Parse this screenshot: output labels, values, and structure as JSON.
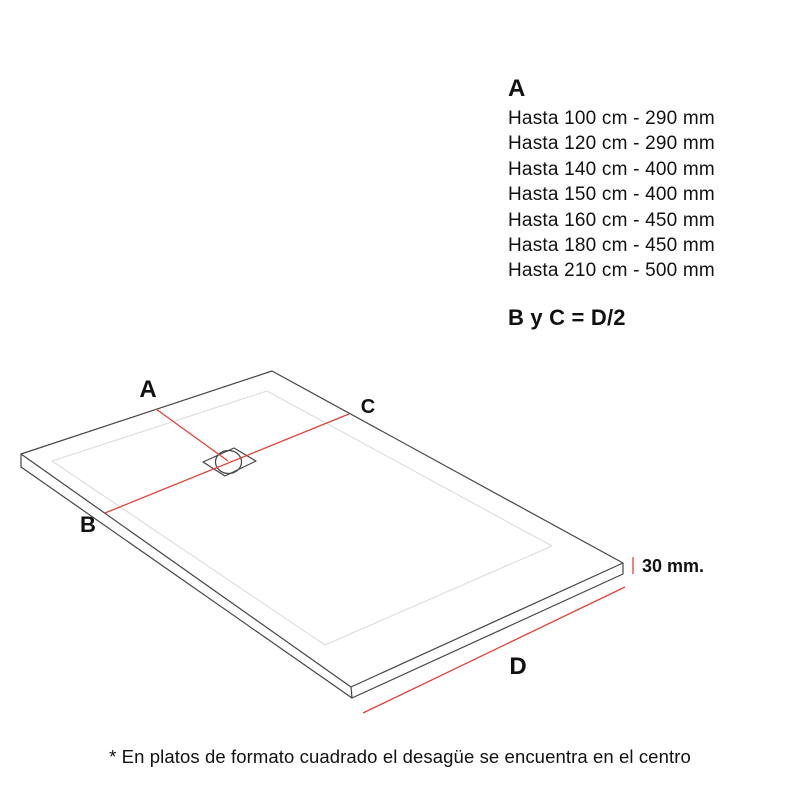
{
  "colors": {
    "ink": "#111111",
    "red": "#e04138",
    "line_dark": "#454545",
    "line_light": "#dcdcdc"
  },
  "spec": {
    "heading": "A",
    "rows": [
      "Hasta 100 cm - 290 mm",
      "Hasta 120 cm - 290 mm",
      "Hasta 140 cm - 400 mm",
      "Hasta 150 cm - 400 mm",
      "Hasta 160 cm - 450 mm",
      "Hasta 180 cm - 450 mm",
      "Hasta 210 cm - 500 mm"
    ],
    "formula": "B y C = D/2"
  },
  "diagram": {
    "label_a": "A",
    "label_b": "B",
    "label_c": "C",
    "label_d": "D",
    "thickness": "30 mm."
  },
  "note": "* En platos de formato cuadrado el desagüe se encuentra en el centro"
}
